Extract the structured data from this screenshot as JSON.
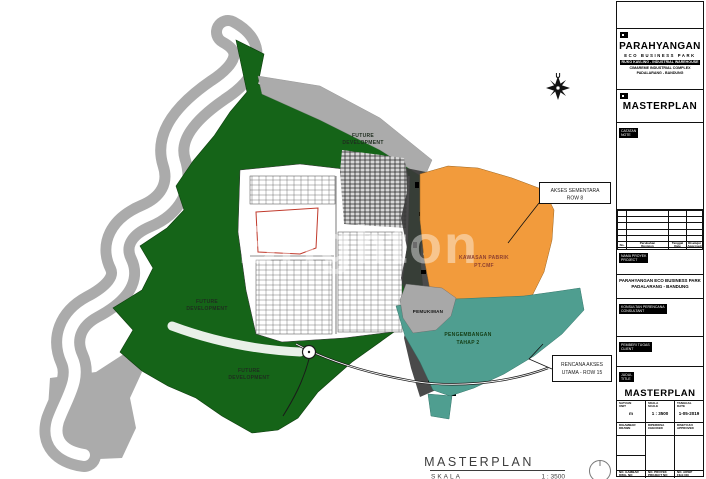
{
  "colors": {
    "green": "#156418",
    "orange": "#F29B3C",
    "teal": "#4F9E90",
    "bank_gray": "#ABABAB",
    "dark_band": "#3B3B3B",
    "factory_text": "#8D3F2F",
    "phase_text": "#143D14"
  },
  "map": {
    "watermark": "Brighton",
    "compass_label": "U",
    "area_labels": {
      "future_development_a": [
        "FUTURE",
        "DEVELOPMENT"
      ],
      "future_development_b": [
        "FUTURE",
        "DEVELOPMENT"
      ],
      "future_development_c": [
        "FUTURE",
        "DEVELOPMENT"
      ],
      "pemukiman": "PEMUKIMAN",
      "pengembangan_tahap2": [
        "PENGEMBANGAN",
        "TAHAP 2"
      ],
      "kawasan_pabrik": [
        "KAWASAN PABRIK",
        "PT.CMF"
      ]
    },
    "callouts": {
      "akses_sementara": [
        "AKSES SEMENTARA",
        "ROW 8"
      ],
      "rencana_akses": [
        "RENCANA AKSES",
        "UTAMA - ROW 15"
      ]
    },
    "caption": {
      "title": "MASTERPLAN",
      "scale_label": "SKALA",
      "scale_value": "1 : 3500"
    }
  },
  "titleblock": {
    "brand": {
      "name": "PARAHYANGAN",
      "park": "ECO BUSINESS PARK",
      "bar": "RUKO KAVLING - INDUSTRIAL WAREHOUSE",
      "complex": "CIMAREME INDUSTRIAL COMPLEX",
      "city": "PADALARANG - BANDUNG"
    },
    "doc_title": "MASTERPLAN",
    "notes_label": [
      "CATATAN",
      "NOTE"
    ],
    "revision_headers": [
      {
        "l1": "No.",
        "l2": ""
      },
      {
        "l1": "Perubahan",
        "l2": "Revision"
      },
      {
        "l1": "Tanggal",
        "l2": "Date"
      },
      {
        "l1": "Disetujui",
        "l2": "Approved"
      }
    ],
    "project_label": [
      "NAMA PROYEK",
      "PROJECT"
    ],
    "project_name": [
      "PARAHYANGAN ECO BUSINESS PARK",
      "PADALARANG - BANDUNG"
    ],
    "consultant_label": [
      "KONSULTAN PERENCANA",
      "CONSULTANT"
    ],
    "client_label": [
      "PEMBERI TUGAS",
      "CLIENT"
    ],
    "title_label": [
      "JUDUL",
      "TITLE"
    ],
    "drawing_title": "MASTERPLAN",
    "fields": {
      "unit_label": [
        "SATUAN",
        "UNIT"
      ],
      "unit_value": "m",
      "scale_label": [
        "SKALA",
        "SCALE"
      ],
      "scale_value": "1 : 3500",
      "date_label": [
        "TANGGAL",
        "DATE"
      ],
      "date_value": "1-05-2019",
      "drawn_label": [
        "DIGAMBAR",
        "DRAWN"
      ],
      "checked_label": [
        "DIPERIKSA",
        "CHECKED"
      ],
      "approved_label": [
        "DISETUJUI",
        "APPROVED"
      ],
      "dwg_no_label": [
        "NO. GAMBAR",
        "DWG. NO"
      ],
      "proj_no_label": [
        "NO. PROYEK",
        "PROJECT NO"
      ],
      "file_no_label": [
        "NO. ARSIP",
        "FILE NO"
      ]
    }
  }
}
